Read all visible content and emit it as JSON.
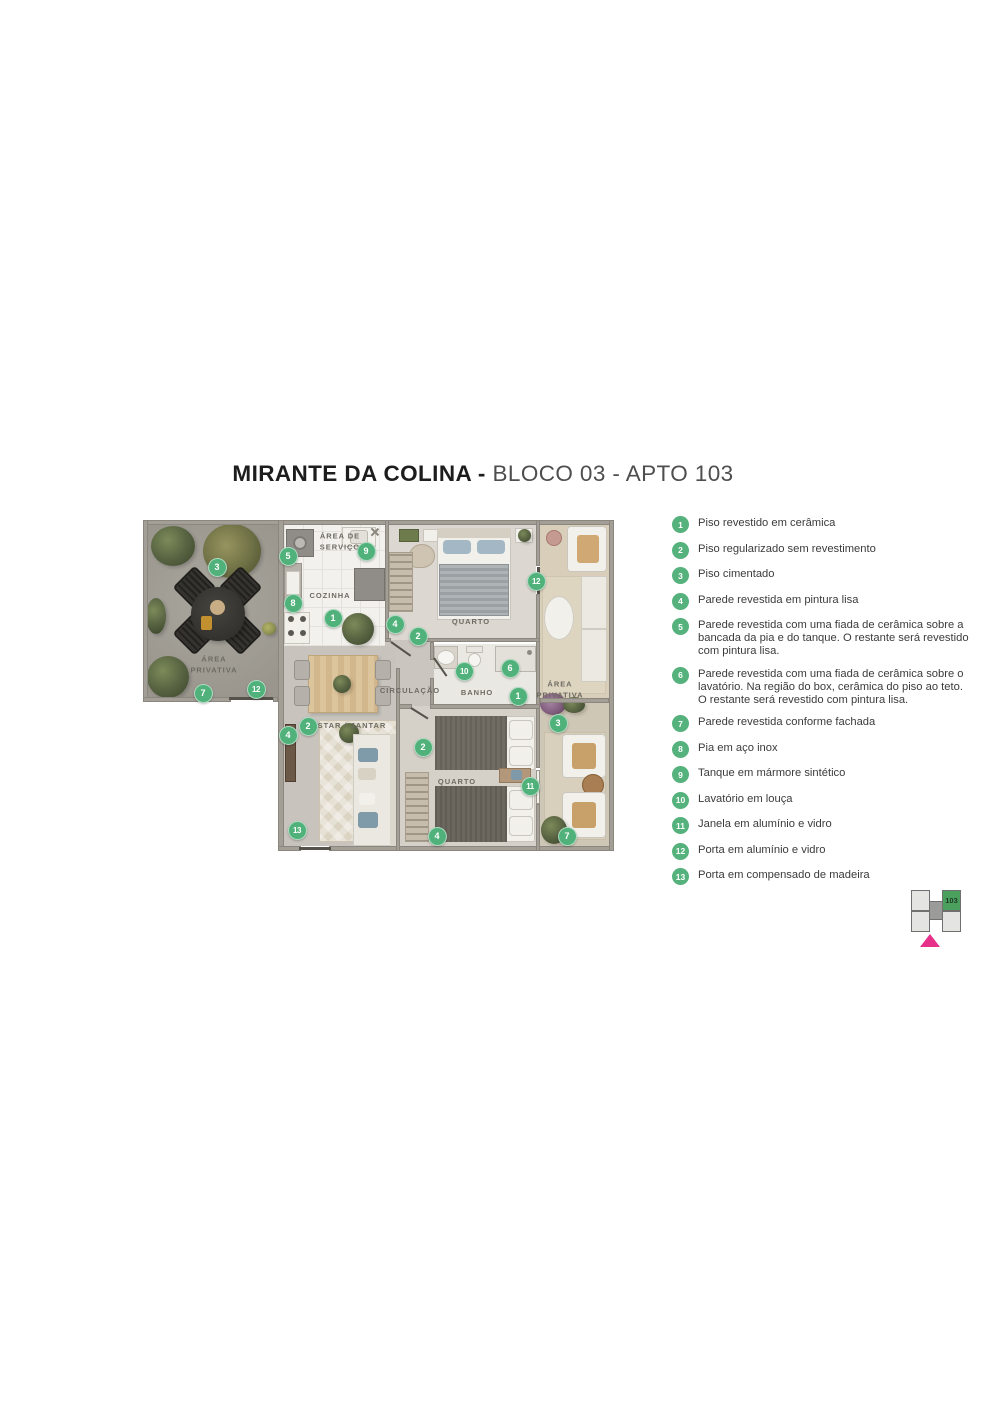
{
  "title": {
    "project": "MIRANTE DA COLINA -",
    "unit": "BLOCO 03 - APTO 103"
  },
  "legend": {
    "items": [
      {
        "num": "1",
        "text": "Piso revestido em cerâmica"
      },
      {
        "num": "2",
        "text": "Piso regularizado sem revestimento"
      },
      {
        "num": "3",
        "text": "Piso cimentado"
      },
      {
        "num": "4",
        "text": "Parede revestida em pintura lisa"
      },
      {
        "num": "5",
        "text": "Parede revestida com uma fiada de cerâmica sobre a bancada da pia e do tanque. O restante será revestido com pintura lisa."
      },
      {
        "num": "6",
        "text": "Parede revestida com uma fiada de cerâmica sobre o lavatório. Na região do box, cerâmica do piso ao teto. O restante será revestido com pintura lisa."
      },
      {
        "num": "7",
        "text": "Parede revestida conforme fachada"
      },
      {
        "num": "8",
        "text": "Pia em aço inox"
      },
      {
        "num": "9",
        "text": "Tanque em mármore sintético"
      },
      {
        "num": "10",
        "text": "Lavatório em louça"
      },
      {
        "num": "11",
        "text": "Janela em alumínio e vidro"
      },
      {
        "num": "12",
        "text": "Porta em alumínio e vidro"
      },
      {
        "num": "13",
        "text": "Porta em compensado de madeira"
      }
    ]
  },
  "plan": {
    "room_labels": [
      {
        "text": "ÁREA\nPRIVATIVA",
        "x": 71,
        "y": 145
      },
      {
        "text": "ÁREA DE\nSERVIÇO",
        "x": 197,
        "y": 22
      },
      {
        "text": "COZINHA",
        "x": 187,
        "y": 76
      },
      {
        "text": "QUARTO",
        "x": 328,
        "y": 102
      },
      {
        "text": "CIRCULAÇÃO",
        "x": 267,
        "y": 171
      },
      {
        "text": "BANHO",
        "x": 334,
        "y": 173
      },
      {
        "text": "ESTAR / JANTAR",
        "x": 206,
        "y": 206
      },
      {
        "text": "QUARTO",
        "x": 314,
        "y": 262
      },
      {
        "text": "ÁREA\nPRIVATIVA",
        "x": 417,
        "y": 170
      }
    ],
    "markers": [
      {
        "num": "3",
        "x": 74,
        "y": 47
      },
      {
        "num": "5",
        "x": 145,
        "y": 36
      },
      {
        "num": "9",
        "x": 223,
        "y": 31
      },
      {
        "num": "8",
        "x": 150,
        "y": 83
      },
      {
        "num": "1",
        "x": 190,
        "y": 98
      },
      {
        "num": "4",
        "x": 252,
        "y": 104
      },
      {
        "num": "2",
        "x": 275,
        "y": 116
      },
      {
        "num": "12",
        "x": 393,
        "y": 61
      },
      {
        "num": "7",
        "x": 60,
        "y": 173
      },
      {
        "num": "12",
        "x": 113,
        "y": 169
      },
      {
        "num": "10",
        "x": 321,
        "y": 151
      },
      {
        "num": "6",
        "x": 367,
        "y": 148
      },
      {
        "num": "1",
        "x": 375,
        "y": 176
      },
      {
        "num": "3",
        "x": 415,
        "y": 203
      },
      {
        "num": "2",
        "x": 165,
        "y": 206
      },
      {
        "num": "4",
        "x": 145,
        "y": 215
      },
      {
        "num": "2",
        "x": 280,
        "y": 227
      },
      {
        "num": "11",
        "x": 387,
        "y": 266
      },
      {
        "num": "13",
        "x": 154,
        "y": 310
      },
      {
        "num": "4",
        "x": 294,
        "y": 316
      },
      {
        "num": "7",
        "x": 424,
        "y": 316
      }
    ]
  },
  "keyplan": {
    "unit_label": "103"
  },
  "colors": {
    "marker_green": "#50b27a",
    "legend_green": "#55b27c",
    "keyplan_green": "#4ba05e",
    "keyplan_pink": "#e6308a"
  }
}
